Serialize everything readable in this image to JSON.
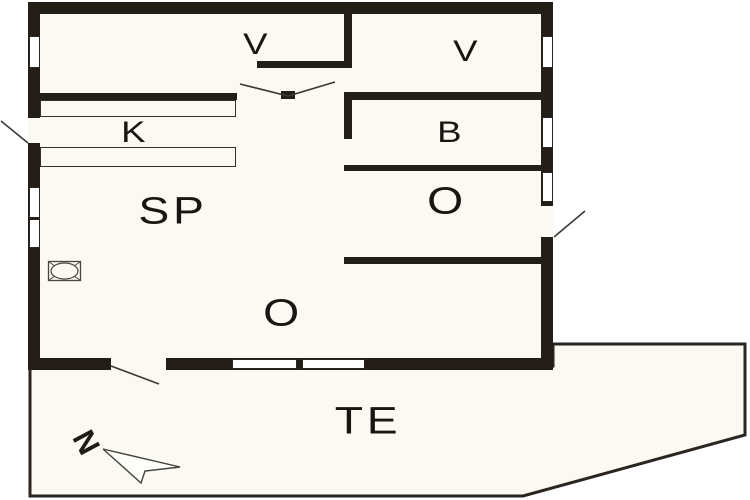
{
  "floorplan": {
    "rooms": [
      {
        "id": "closet-top-left",
        "label": "V"
      },
      {
        "id": "room-top-right",
        "label": "V"
      },
      {
        "id": "kitchen",
        "label": "K"
      },
      {
        "id": "bathroom",
        "label": "B"
      },
      {
        "id": "room-sp",
        "label": "SP"
      },
      {
        "id": "room-o-right",
        "label": "O"
      },
      {
        "id": "living-room-o",
        "label": "O"
      },
      {
        "id": "terrace",
        "label": "TE"
      }
    ],
    "compass": {
      "north_label": "N"
    },
    "colors": {
      "wall": "#241e18",
      "floor": "#faf9f2",
      "background": "#ffffff",
      "thin_line": "#3c3834"
    }
  }
}
